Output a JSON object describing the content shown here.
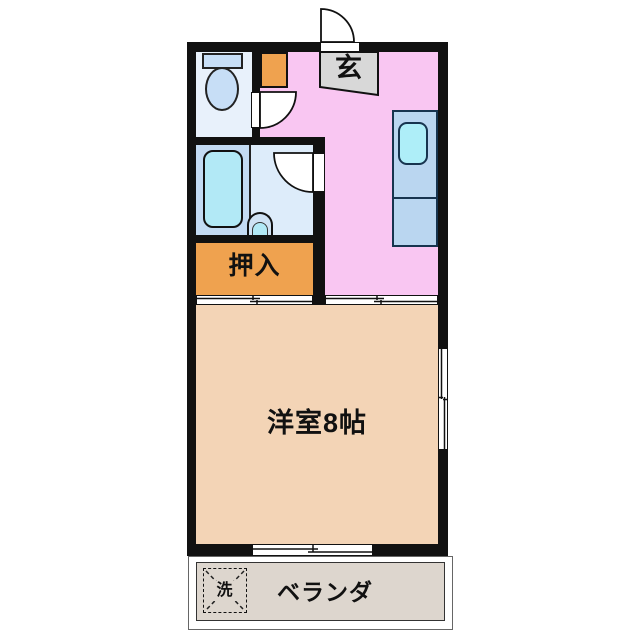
{
  "document": {
    "type": "apartment-floor-plan"
  },
  "rooms": {
    "entrance": {
      "label": "玄"
    },
    "closet": {
      "label": "押入"
    },
    "western_room": {
      "label": "洋室8帖"
    },
    "veranda": {
      "label": "ベランダ"
    },
    "washing_machine": {
      "label": "洗"
    }
  },
  "icons": {
    "toilet": "toilet-icon",
    "bathtub": "bathtub-icon",
    "washbasin": "washbasin-icon",
    "kitchen_sink": "kitchen-sink-icon",
    "entrance_door": "entrance-door-swing-icon",
    "toilet_door": "toilet-door-swing-icon",
    "bathroom_door": "bathroom-door-swing-icon",
    "sliding_door": "sliding-door-icon",
    "window": "window-icon",
    "washer_space": "washing-machine-space-icon"
  },
  "colors": {
    "wall": "#111111",
    "kitchen_hall_pink": "#f9c6f2",
    "western_room_tan": "#f3d4b6",
    "closet_orange": "#efa24f",
    "genkan_gray": "#d8d8d8",
    "toilet_room_blue": "#e8f1fb",
    "fixture_blue": "#c7def6",
    "bath_blue": "#c3dbf3",
    "washroom_blue": "#ddecfa",
    "water_cyan": "#b2e9f6",
    "counter_blue": "#bad6f0",
    "counter_sink_cyan": "#aeeef8",
    "veranda_gray": "#ddd6ce",
    "door_white": "#ffffff"
  }
}
